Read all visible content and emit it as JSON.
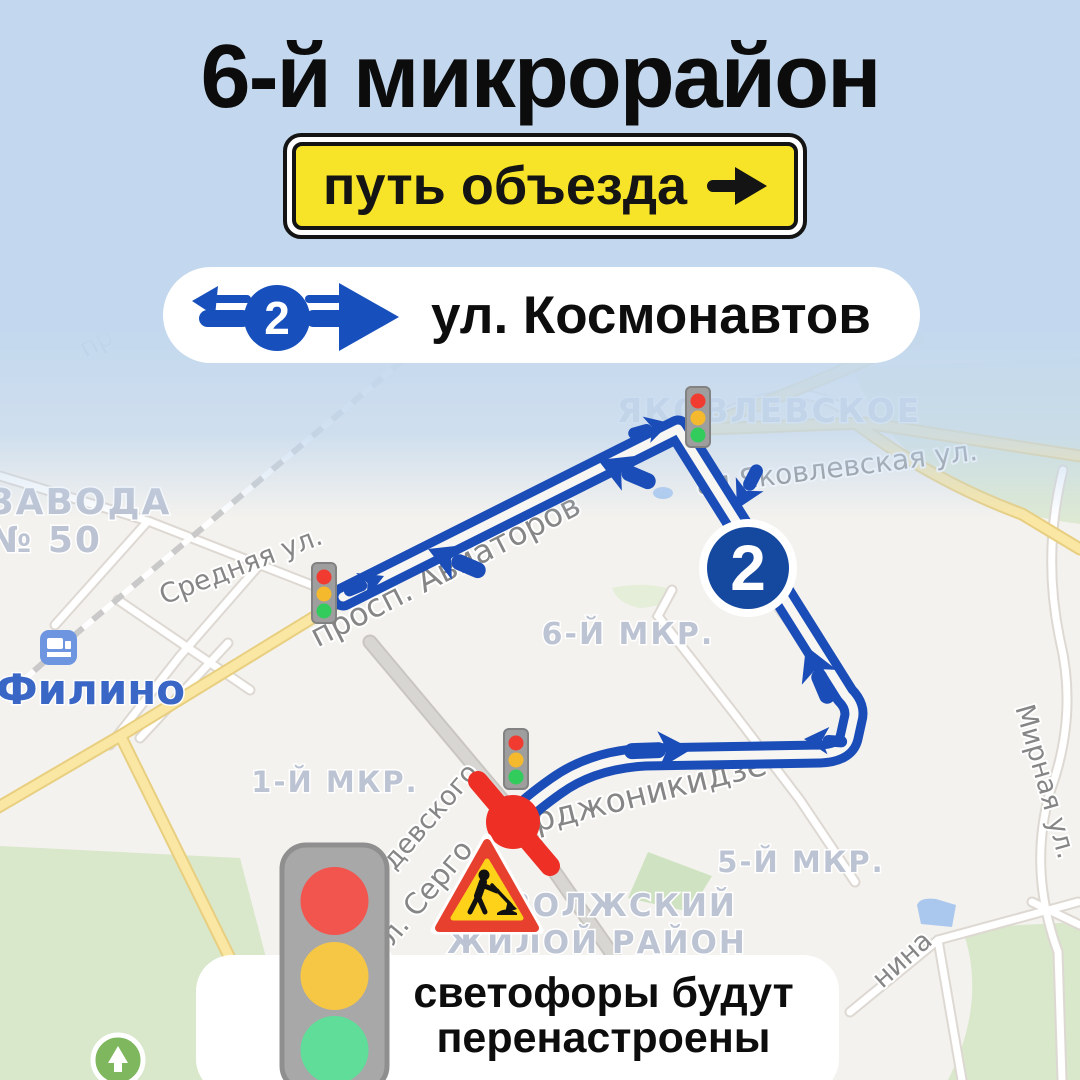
{
  "header": {
    "title": "6-й микрорайон"
  },
  "detour_sign": {
    "text": "путь объезда",
    "arrow_icon": "right-arrow"
  },
  "route_pill": {
    "number": "2",
    "street": "ул. Космонавтов"
  },
  "map": {
    "badge_number": "2",
    "labels": {
      "yakovlevskoye": "ЯКОВЛЕВСКОЕ",
      "yakovlevskaya": "ая Яковлевская ул.",
      "srednyaya": "Средняя ул.",
      "aviatorov": "просп. Авиаторов",
      "mkr6": "6-Й МКР.",
      "mkr1": "1-Й МКР.",
      "mkr5": "5-Й МКР.",
      "mirnaya": "Мирная ул.",
      "filino": "Филино",
      "zavoda1": "ЗАВОДА",
      "zavoda2": "№ 50",
      "zhiloy1": "ЗАВОЛЖСКИЙ",
      "zhiloy2": "ЖИЛОЙ РАЙОН",
      "ordzhonikidze1": "ул. Серго",
      "ordzhonikidze2": "Орджоникидзе",
      "devskogo": "девского",
      "nina": "нина",
      "pr": "пр"
    }
  },
  "footer": {
    "line1": "светофоры будут",
    "line2": "перенастроены"
  },
  "colors": {
    "background": "#c3d8ee",
    "sign_yellow": "#f7e428",
    "route_blue": "#1b4db8",
    "badge_blue": "#15489f",
    "closure_red": "#ee2f26",
    "light_red": "#f2544e",
    "light_yellow": "#f6c645",
    "light_green": "#5fdd99"
  }
}
